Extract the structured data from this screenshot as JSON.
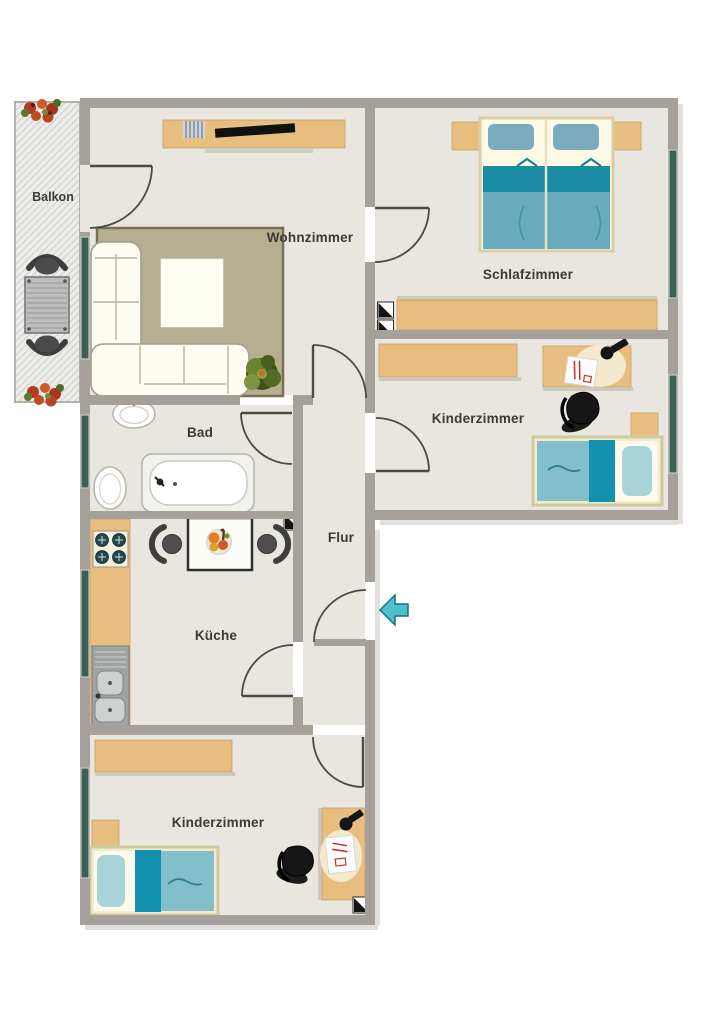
{
  "page": {
    "type": "apartment-floor-plan",
    "background": "#ffffff"
  },
  "rooms": {
    "balkon": {
      "label": "Balkon"
    },
    "wohnzimmer": {
      "label": "Wohnzimmer"
    },
    "schlafzimmer": {
      "label": "Schlafzimmer"
    },
    "kinderzimmer_rechts": {
      "label": "Kinderzimmer"
    },
    "bad": {
      "label": "Bad"
    },
    "flur": {
      "label": "Flur"
    },
    "kueche": {
      "label": "Küche"
    },
    "kinderzimmer_unten": {
      "label": "Kinderzimmer"
    }
  },
  "icons": [
    "entrance-arrow-icon",
    "shaft-symbol",
    "double-bed",
    "single-bed",
    "sofa-l-shape",
    "coffee-table",
    "rug",
    "sideboard-tv",
    "wardrobe",
    "desk-with-lamp",
    "office-chair",
    "bathtub",
    "sink",
    "toilet",
    "kitchen-counter",
    "stove",
    "kitchen-sink",
    "dining-table",
    "chair",
    "balcony-table",
    "balcony-chair",
    "flower-box",
    "plant"
  ],
  "colors": {
    "wall": "#a5a09a",
    "floor": "#e9e6df",
    "furniture_wood": "#e7bd80",
    "bed_teal_dark": "#1a8da4",
    "bed_teal_light": "#7cbcca",
    "pillow_blue": "#7babbc",
    "rug": "#b6ae92",
    "window_glass": "#3c5f56",
    "entrance_arrow": "#4cc0cd",
    "sofa_white": "#fffdf2",
    "appliance_gray": "#9fa3a3"
  }
}
